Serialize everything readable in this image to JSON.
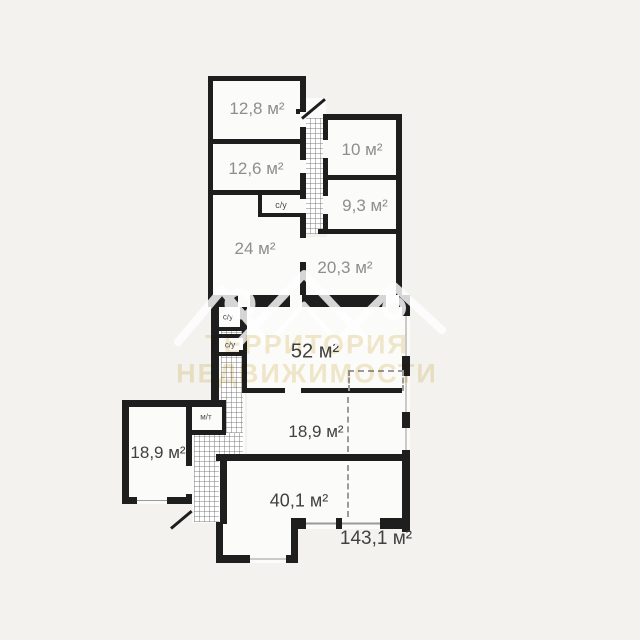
{
  "plan_title": "apartment-floor-plan",
  "labels": {
    "r128": "12,8 м²",
    "r126": "12,6 м²",
    "r24": "24 м²",
    "r10": "10 м²",
    "r93": "9,3 м²",
    "r203": "20,3 м²",
    "r52": "52 м²",
    "r189_left": "18,9 м²",
    "r189_right": "18,9 м²",
    "r401": "40,1 м²",
    "total_area": "143,1 м²",
    "bathroom_top": "с/у",
    "bathroom_1": "с/у",
    "bathroom_2": "с/у",
    "utility": "м/т"
  },
  "watermark": {
    "line1": "ТЕРРИТОРИЯ",
    "line2": "НЕДВИЖИМОСТИ",
    "text_color": "#f3e9cd",
    "logo": "roof-peaks-with-location-pins"
  },
  "colors": {
    "background": "#f3f2ef",
    "room_fill": "#fbfbfa",
    "wall": "#1e1e1e",
    "label_gray": "#8e8e8e",
    "label_dark": "#414141",
    "hatch_line": "#6e6e6e"
  }
}
